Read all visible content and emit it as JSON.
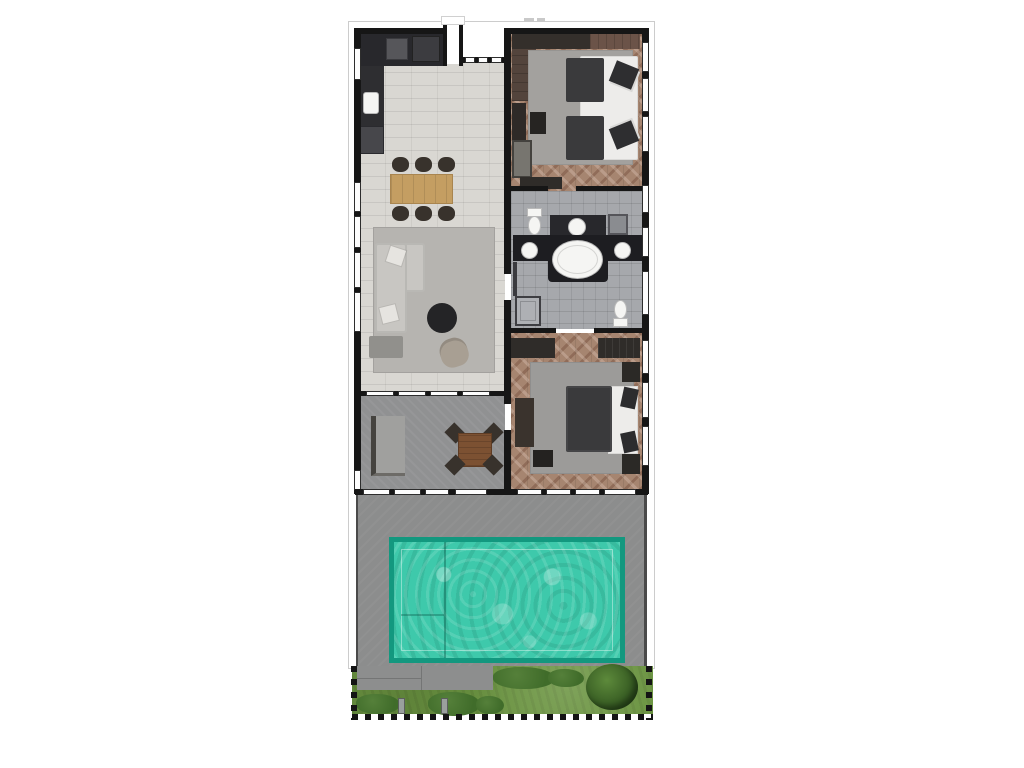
{
  "document": {
    "kind": "villa floor plan, top-down render, no visible room labels",
    "annotation": {
      "tiny_dimension_text_top": "illegible"
    }
  },
  "plan": {
    "rooms": [
      {
        "name": "kitchen-dining-living",
        "floor": "light subway tile",
        "furniture": [
          "l-shaped kitchen counter",
          "kitchen sink",
          "cooktop",
          "dining table",
          "six dining chairs",
          "l-shaped sofa",
          "two throw pillows",
          "ottoman",
          "round coffee table",
          "armchair",
          "area rug"
        ]
      },
      {
        "name": "terrace-lounge",
        "floor": "grey concrete",
        "furniture": [
          "daybed sofa",
          "square wood table",
          "four chairs"
        ]
      },
      {
        "name": "bedroom-1",
        "floor": "herringbone wood",
        "furniture": [
          "wardrobe row",
          "closet",
          "double bed",
          "dark duvets",
          "pillows",
          "bench",
          "side table",
          "dresser",
          "console",
          "area rug"
        ]
      },
      {
        "name": "bathroom",
        "floor": "grey tile",
        "furniture": [
          "toilet upper",
          "counter with basin",
          "niche",
          "double vanity",
          "two round sinks",
          "oval bathtub",
          "shower tray",
          "toilet lower"
        ]
      },
      {
        "name": "bedroom-2",
        "floor": "herringbone wood",
        "furniture": [
          "wardrobe strips",
          "double bed",
          "mattress edge",
          "two pillows",
          "two nightstands",
          "bench",
          "dresser",
          "area rug"
        ]
      }
    ],
    "outdoor": {
      "deck": "grey pool deck",
      "pool": {
        "shape": "rectangle",
        "steps": "left compartment with divider lines"
      },
      "garden": [
        "lawn",
        "paved walkway",
        "two posts",
        "bushes",
        "round tree"
      ],
      "boundary": "dashed black property line on left, right and bottom of garden"
    },
    "openings": {
      "entry": "recessed entry notch at top between wings",
      "glazing": "window strips on left and right walls, glass sliders on south wall and between living room and terrace"
    }
  },
  "colors": {
    "wall": "#161616",
    "eave": "#cccccc",
    "tile_floor": "#d9d7d2",
    "tile_grout": "rgba(0,0,0,0.08)",
    "wood_floor": "#a68570",
    "wood_floor_dark": "rgba(92,52,35,0.30)",
    "wood_floor_light": "rgba(255,240,230,0.22)",
    "bath_tile": "#a6a8ac",
    "concrete": "#909192",
    "deck": "#8c8d8d",
    "rug_living": "#b6b4b0",
    "rug_bed1": "#a3a19e",
    "rug_bed2": "#9c9b99",
    "sofa": "#c8c6c2",
    "pillow": "#e6e4e0",
    "ottoman": "#91908c",
    "coffee_table": "#242426",
    "armchair": "#a89f93",
    "wood_table": "#c49e62",
    "wood_table_dark": "#7c5132",
    "chair_dark": "#38322c",
    "dark_furniture": "#2f2c28",
    "duvet": "#3a3a3c",
    "bed_white": "#edecea",
    "counter_dark": "#28282c",
    "vanity": "#1d1d21",
    "fixture": "#f5f5f3",
    "fixture_border": "#b9b9b9",
    "metal": "#8a8c90",
    "pool_border": "#13987f",
    "pool_water": "#3ec9ab",
    "grass": "#6b9441",
    "bush": "#406c2a",
    "tree": "#2e511d",
    "walkway": "#8d8e8e",
    "window": "#fdfdfd",
    "boundary": "#141414"
  }
}
